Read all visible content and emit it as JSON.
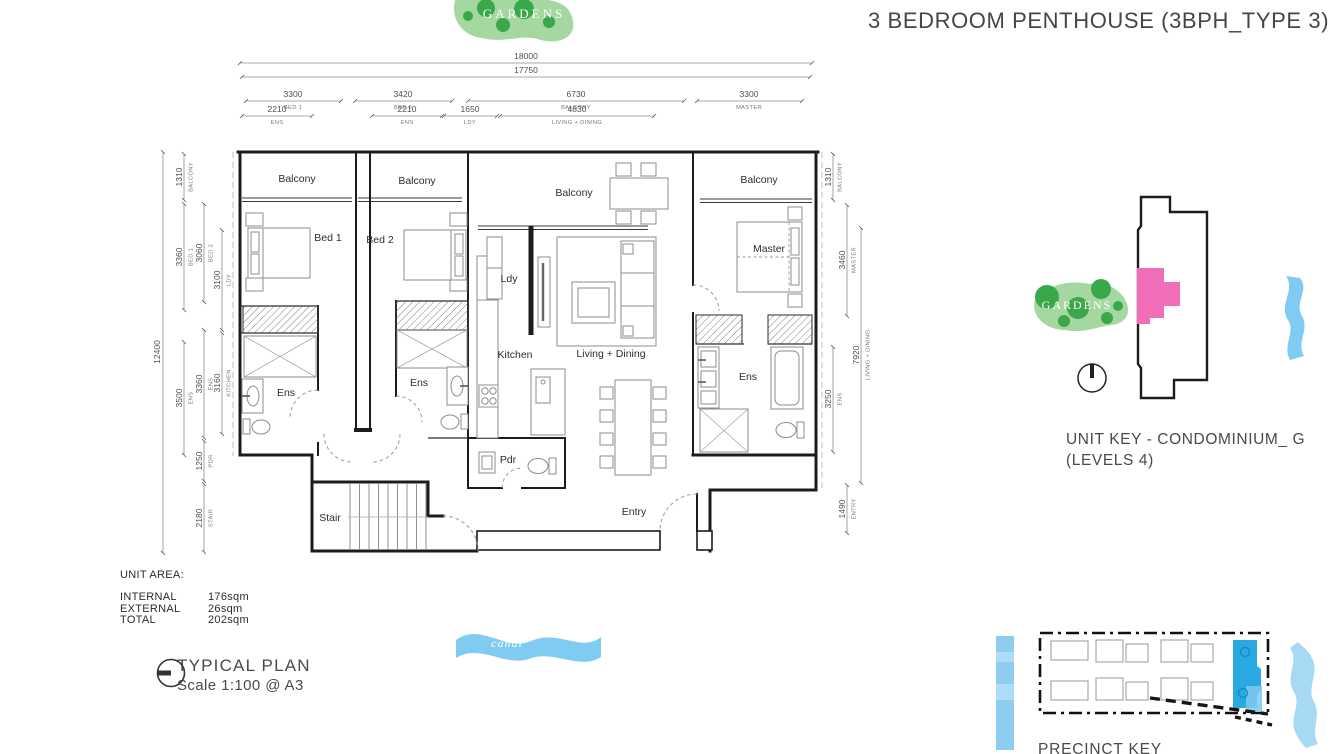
{
  "title": "3 BEDROOM PENTHOUSE (3BPH_TYPE 3)",
  "floor_plan": {
    "room_labels": {
      "balcony_bed1": "Balcony",
      "balcony_bed2": "Balcony",
      "balcony_living": "Balcony",
      "balcony_master": "Balcony",
      "bed1": "Bed 1",
      "bed2": "Bed 2",
      "ldy": "Ldy",
      "master": "Master",
      "kitchen": "Kitchen",
      "living_dining": "Living + Dining",
      "ens_bed1": "Ens",
      "ens_bed2": "Ens",
      "ens_master": "Ens",
      "pdr": "Pdr",
      "stair": "Stair",
      "entry": "Entry"
    },
    "dims_top": [
      {
        "value": "18000",
        "label": ""
      },
      {
        "value": "17750",
        "label": ""
      },
      {
        "value": "3300",
        "label": "BED 1"
      },
      {
        "value": "3420",
        "label": "BED 2"
      },
      {
        "value": "6730",
        "label": "BALCONY"
      },
      {
        "value": "3300",
        "label": "MASTER"
      },
      {
        "value": "2210",
        "label": "ENS"
      },
      {
        "value": "2210",
        "label": "ENS"
      },
      {
        "value": "1650",
        "label": "LDY"
      },
      {
        "value": "4830",
        "label": "LIVING + DINING"
      }
    ],
    "dims_left": [
      {
        "value": "12400",
        "label": ""
      },
      {
        "value": "1310",
        "label": "BALCONY"
      },
      {
        "value": "3360",
        "label": "BED 1"
      },
      {
        "value": "3500",
        "label": "ENS"
      },
      {
        "value": "3060",
        "label": "BED 2"
      },
      {
        "value": "3360",
        "label": "ENS"
      },
      {
        "value": "1250",
        "label": "PDR"
      },
      {
        "value": "2180",
        "label": "STAIR"
      },
      {
        "value": "3100",
        "label": "LDY"
      },
      {
        "value": "3160",
        "label": "KITCHEN"
      }
    ],
    "dims_right": [
      {
        "value": "1310",
        "label": "BALCONY"
      },
      {
        "value": "3460",
        "label": "MASTER"
      },
      {
        "value": "3250",
        "label": "ENS"
      },
      {
        "value": "7920",
        "label": "LIVING + DINING"
      },
      {
        "value": "1490",
        "label": "ENTRY"
      }
    ]
  },
  "unit_area": {
    "heading": "UNIT AREA:",
    "rows": [
      {
        "label": "INTERNAL",
        "value": "176sqm"
      },
      {
        "label": "EXTERNAL",
        "value": "26sqm"
      },
      {
        "label": "TOTAL",
        "value": "202sqm"
      }
    ]
  },
  "plan_caption": {
    "title": "TYPICAL PLAN",
    "scale": "Scale 1:100 @ A3"
  },
  "unit_key": {
    "title": "UNIT KEY - CONDOMINIUM_ G",
    "subtitle": "(LEVELS 4)",
    "gardens_label": "GARDENS"
  },
  "site_labels": {
    "gardens": "GARDENS",
    "canal": "canal"
  },
  "precinct_key": {
    "title": "PRECINCT KEY"
  },
  "colors": {
    "accent_pink": "#f06eb8",
    "garden_green_light": "#a5d7a0",
    "garden_green_dark": "#3aa74a",
    "water_blue": "#7fcbf1",
    "highlight_blue": "#29a9e1",
    "wall_black": "#1c1c1c"
  }
}
